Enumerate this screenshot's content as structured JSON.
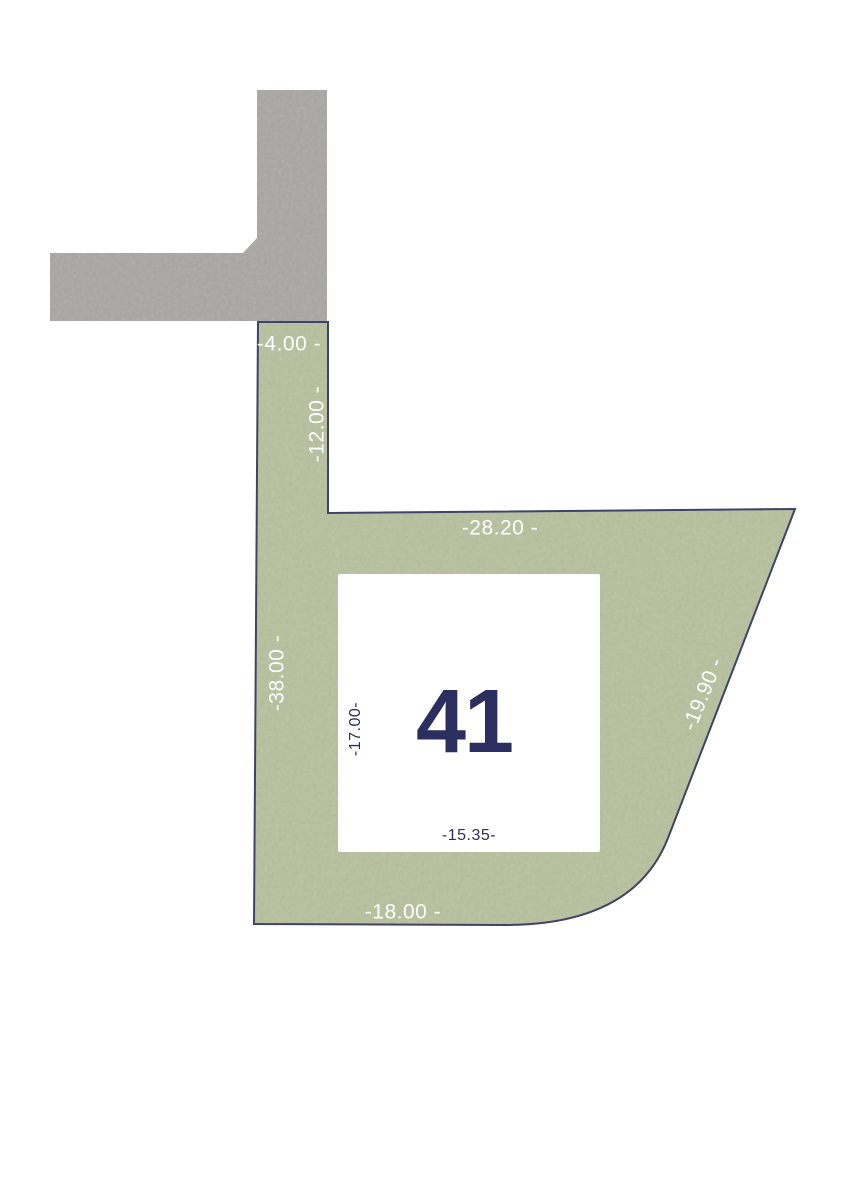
{
  "plan": {
    "type": "land-plot-site-plan",
    "plot": {
      "number": "41",
      "measurements": {
        "street_frontage_top": "-4.00 -",
        "upper_strip_right": "-12.00 -",
        "upper_edge": "-28.20 -",
        "left_edge": "-38.00 -",
        "right_edge": "-19.90 -",
        "building_depth": "-17.00-",
        "building_width": "-15.35-",
        "bottom_edge": "-18.00 -"
      }
    },
    "colors": {
      "background": "#ffffff",
      "parcel_fill": "#b6c19d",
      "parcel_outline": "#3e4367",
      "road_fill": "#a8a7a5",
      "building_fill": "#ffffff",
      "label_light": "#ffffff",
      "label_dark": "#2b2e5e"
    }
  }
}
